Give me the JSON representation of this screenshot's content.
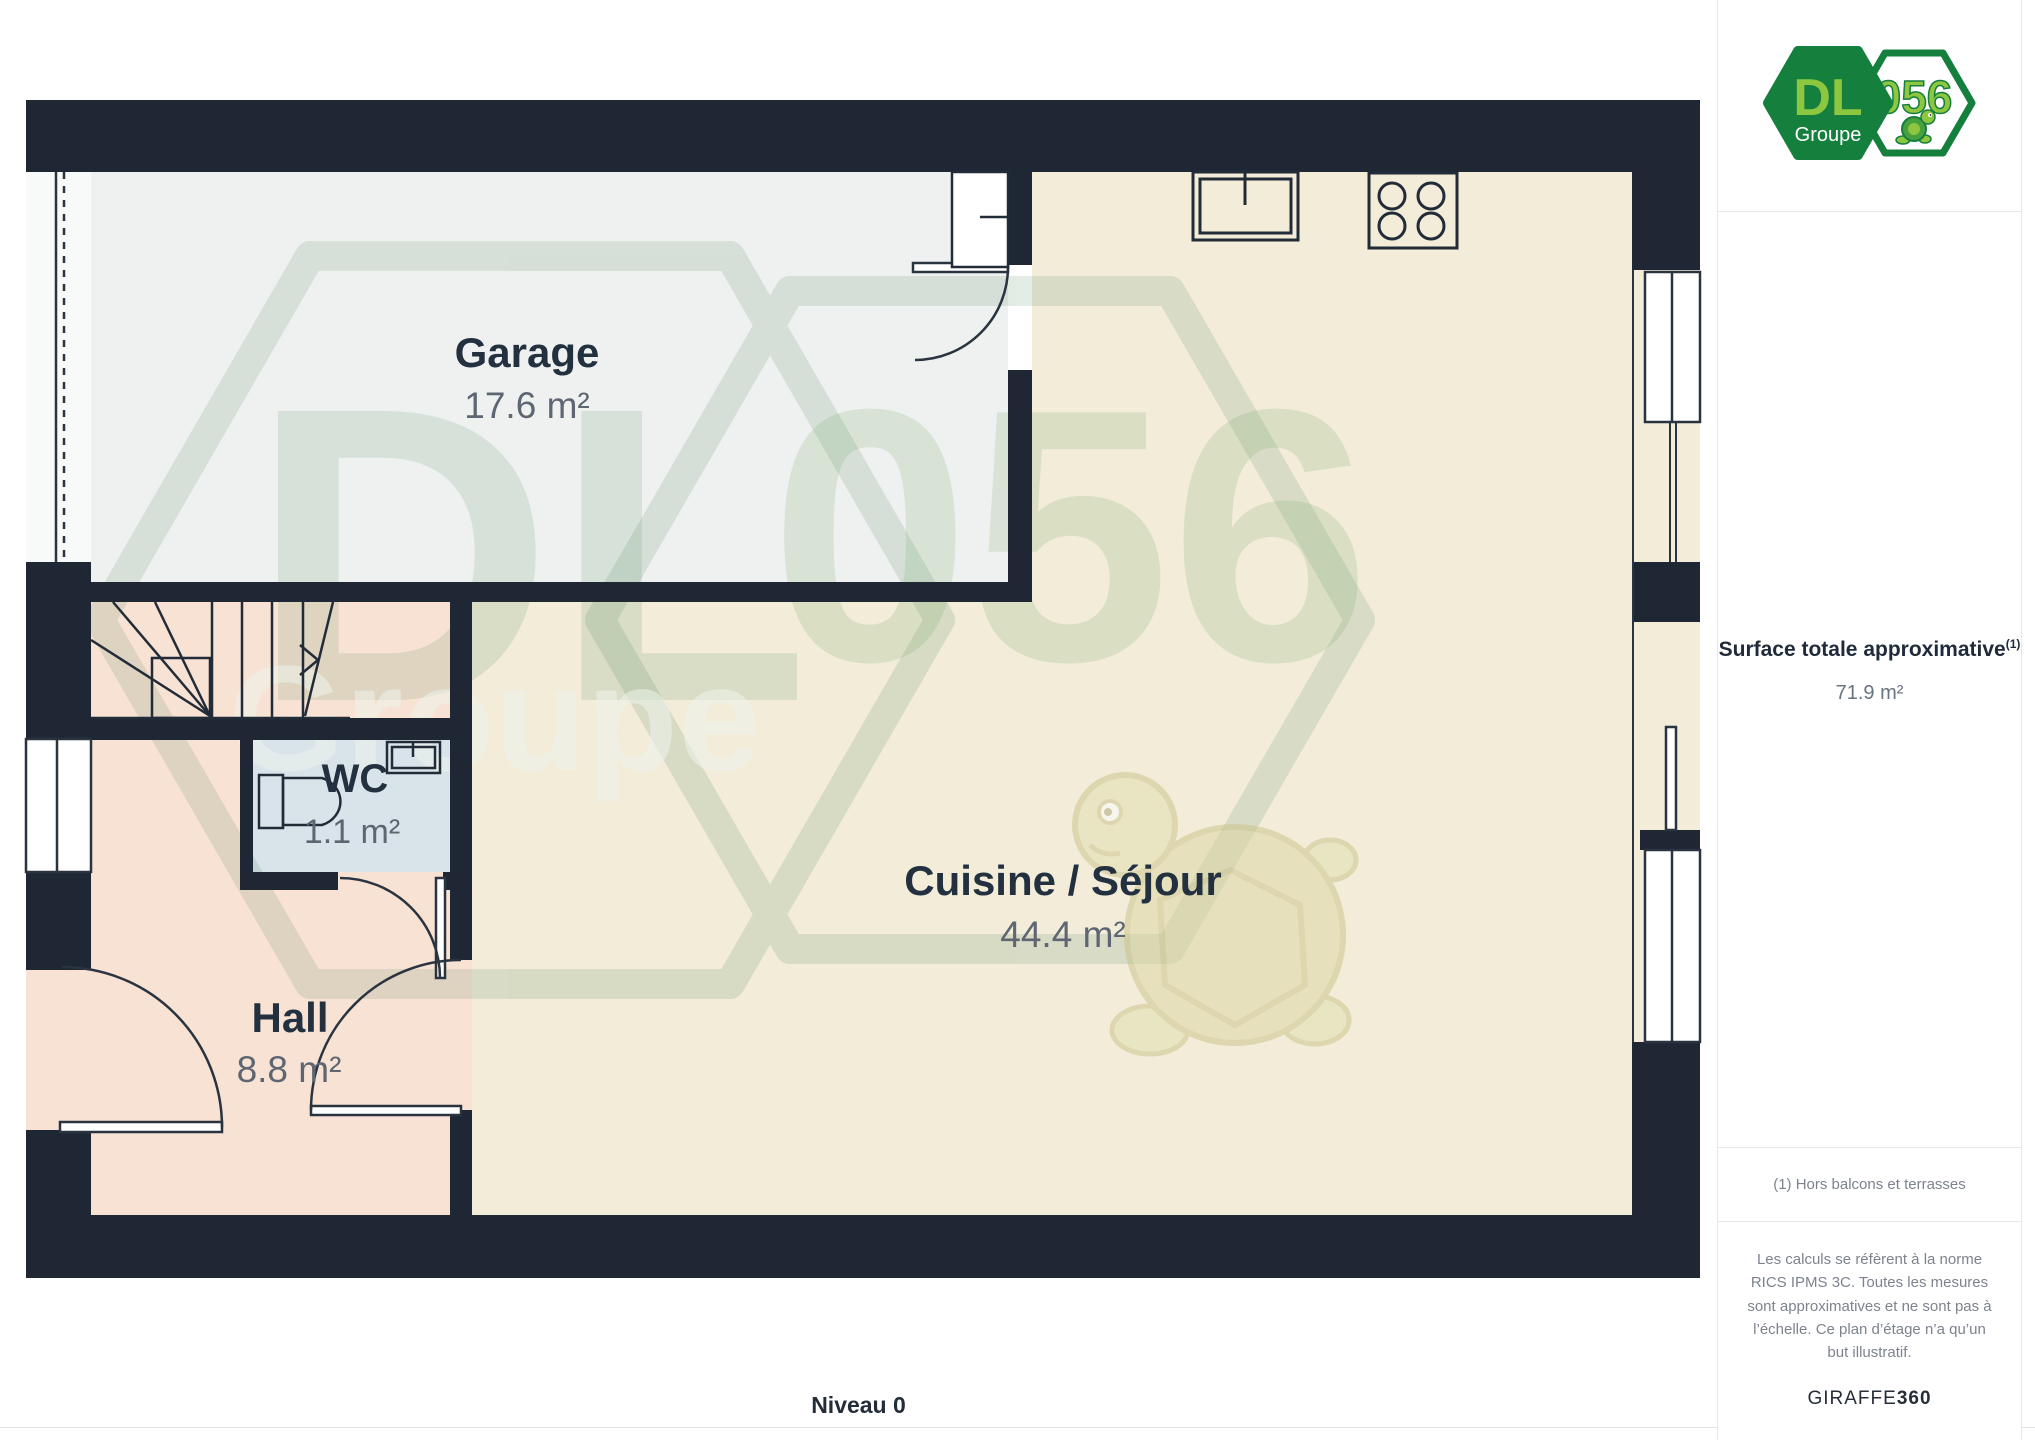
{
  "page": {
    "level_label": "Niveau 0"
  },
  "logo": {
    "dl": "DL",
    "groupe": "Groupe",
    "code": "056"
  },
  "sidebar": {
    "surface_title": "Surface totale approximative",
    "surface_ref": "(1)",
    "surface_value": "71.9 m²",
    "footnote": "(1) Hors balcons et terrasses",
    "disclaimer": "Les calculs se réfèrent à la norme RICS IPMS 3C. Toutes les mesures sont approximatives et ne sont pas à l’échelle. Ce plan d’étage n’a qu’un but illustratif.",
    "brand": "GIRAFFE",
    "brand_bold": "360"
  },
  "floorplan": {
    "rooms": [
      {
        "name": "Garage",
        "area": "17.6 m²"
      },
      {
        "name": "WC",
        "area": "1.1 m²"
      },
      {
        "name": "Hall",
        "area": "8.8 m²"
      },
      {
        "name": "Cuisine / Séjour",
        "area": "44.4 m²"
      }
    ]
  },
  "colors": {
    "wall": "#1e2733",
    "garage_floor": "#eff1f0",
    "kitchen_floor": "#f2ecd9",
    "hall_floor": "#f8e2d3",
    "wc_floor": "#d9e4ea",
    "logo_green_dark": "#157f3d",
    "logo_green_light": "#8dc63f"
  }
}
